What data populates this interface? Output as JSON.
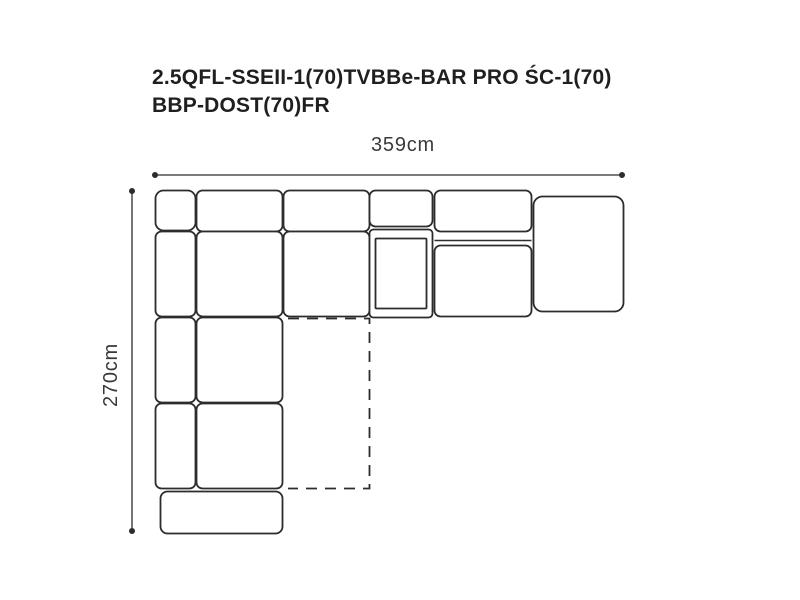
{
  "title": {
    "line1": "2.5QFL-SSEII-1(70)TVBBe-BAR PRO ŚC-1(70)",
    "line2": "BBP-DOST(70)FR"
  },
  "dimensions": {
    "width_label": "359cm",
    "depth_label": "270cm"
  },
  "colors": {
    "background": "#ffffff",
    "line": "#2c2c2c",
    "title_text": "#1f1f1f",
    "dimension_text": "#3a3a3a"
  },
  "diagram": {
    "type": "corner-sofa-top-view-technical-drawing",
    "pieces": [
      "corner-backrest",
      "backrest-segment-2",
      "backrest-segment-3",
      "bar-backrest",
      "backrest-segment-4",
      "right-addon-module",
      "left-arm-upper",
      "seat-1",
      "seat-2",
      "bar-module-with-inner-panel",
      "seat-3",
      "left-arm-mid",
      "seat-4",
      "left-arm-lower",
      "seat-5",
      "front-ottoman",
      "dashed-foldout-outline"
    ]
  }
}
